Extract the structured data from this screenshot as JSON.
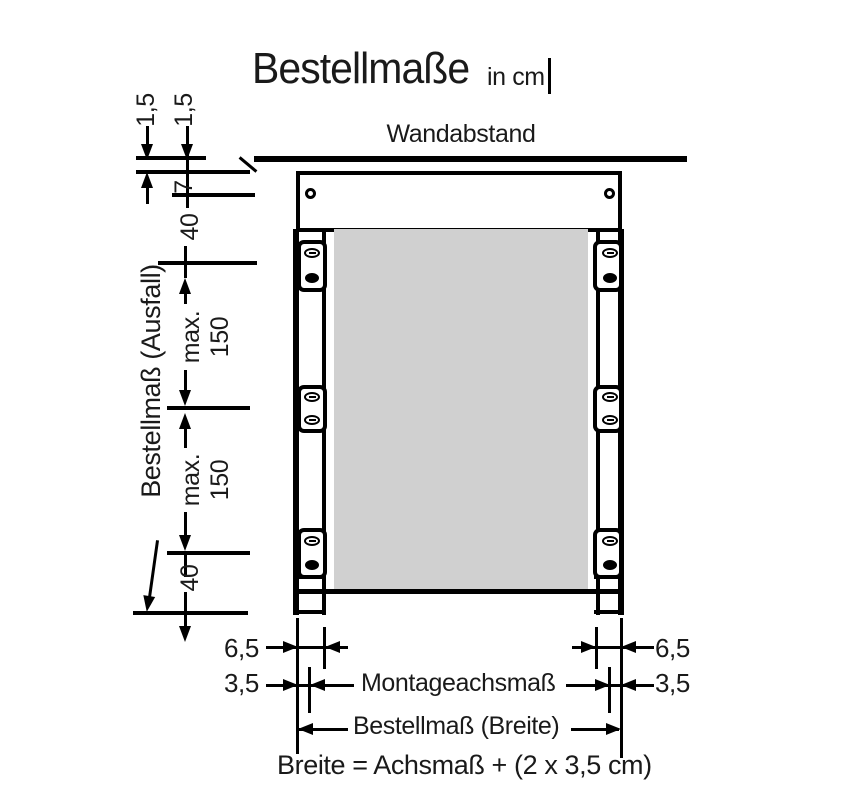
{
  "title": {
    "text": "Bestellmaße",
    "unit": "in cm"
  },
  "wall": {
    "label": "Wandabstand"
  },
  "left_dims": {
    "d1": "1,5",
    "d2": "1,5",
    "d3": "7",
    "d4": "40",
    "max1": {
      "l1": "max.",
      "l2": "150"
    },
    "max2": {
      "l1": "max.",
      "l2": "150"
    },
    "d7": "40",
    "axis_label": "Bestellmaß (Ausfall)"
  },
  "bottom_dims": {
    "left_65": "6,5",
    "left_35": "3,5",
    "right_65": "6,5",
    "right_35": "3,5",
    "montage": "Montageachsmaß",
    "breite": "Bestellmaß (Breite)",
    "formula": "Breite = Achsmaß + (2 x 3,5 cm)"
  },
  "colors": {
    "line": "#000000",
    "panel": "#d0d0d0",
    "background": "#ffffff"
  }
}
